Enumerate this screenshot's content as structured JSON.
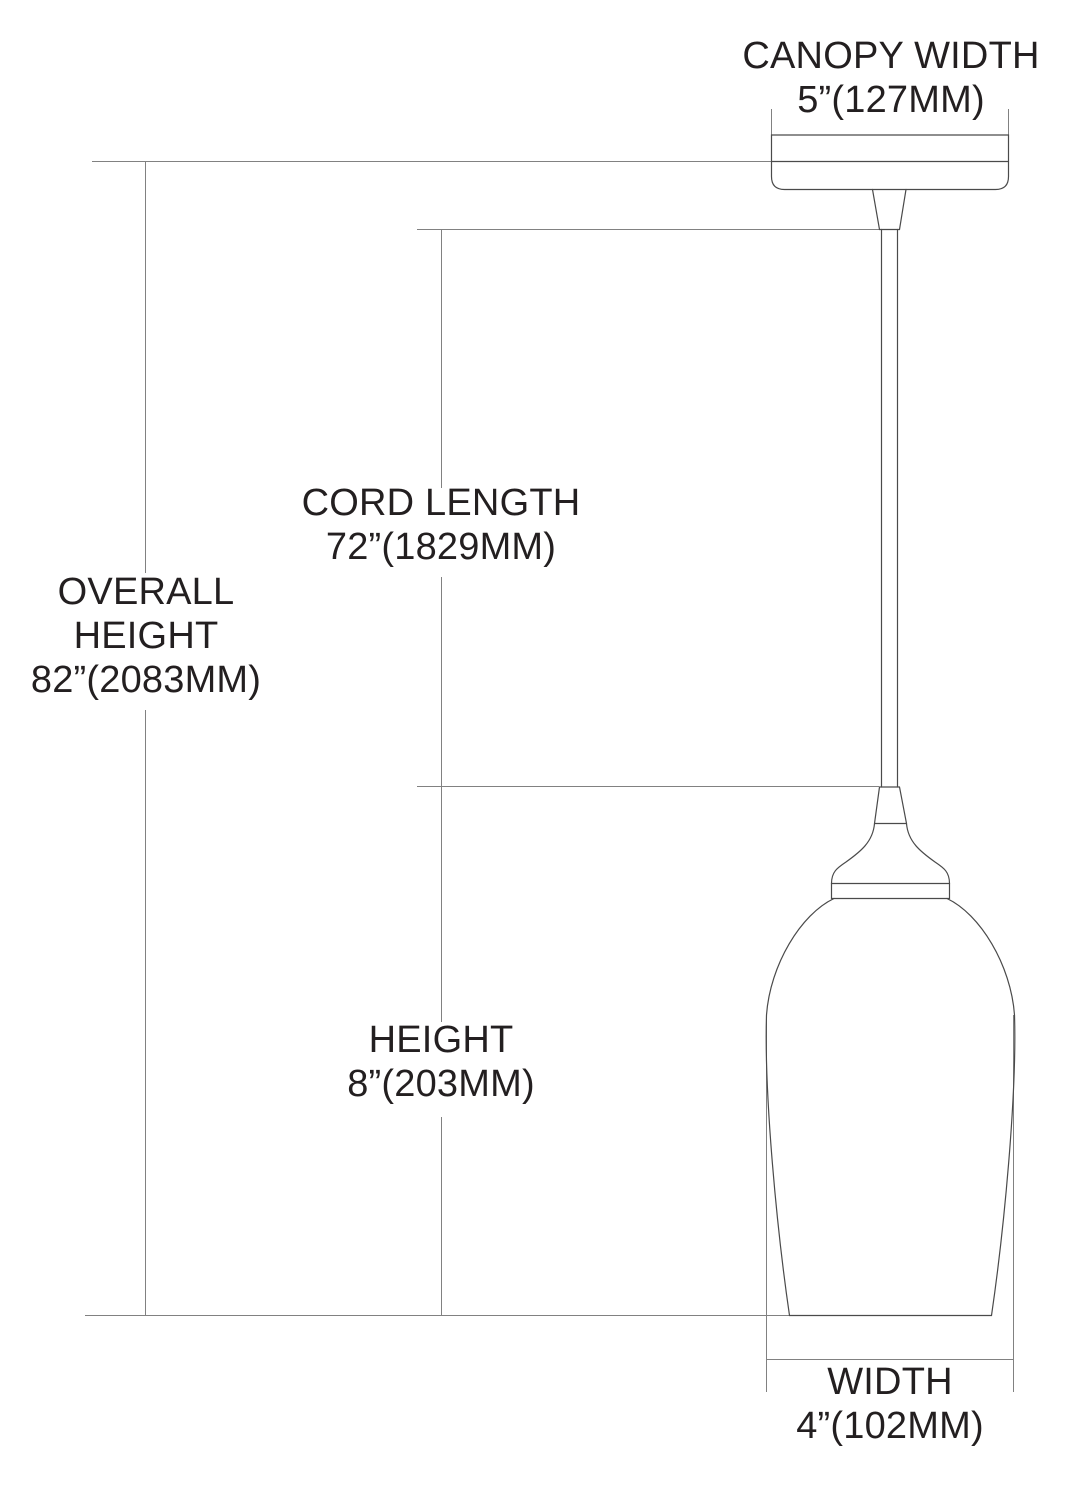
{
  "diagram_title": "Pendant light fixture dimension diagram",
  "dimensions": {
    "canopy_width": {
      "label": "CANOPY WIDTH",
      "value": "5”(127MM)"
    },
    "cord_length": {
      "label": "CORD LENGTH",
      "value": "72”(1829MM)"
    },
    "overall_height": {
      "label_line1": "OVERALL",
      "label_line2": "HEIGHT",
      "value": "82”(2083MM)"
    },
    "height": {
      "label": "HEIGHT",
      "value": "8”(203MM)"
    },
    "width": {
      "label": "WIDTH",
      "value": "4”(102MM)"
    }
  },
  "colors": {
    "background": "#ffffff",
    "fixture_outline": "#4a4a4a",
    "dimension_lines": "#818181",
    "text": "#231f20"
  }
}
